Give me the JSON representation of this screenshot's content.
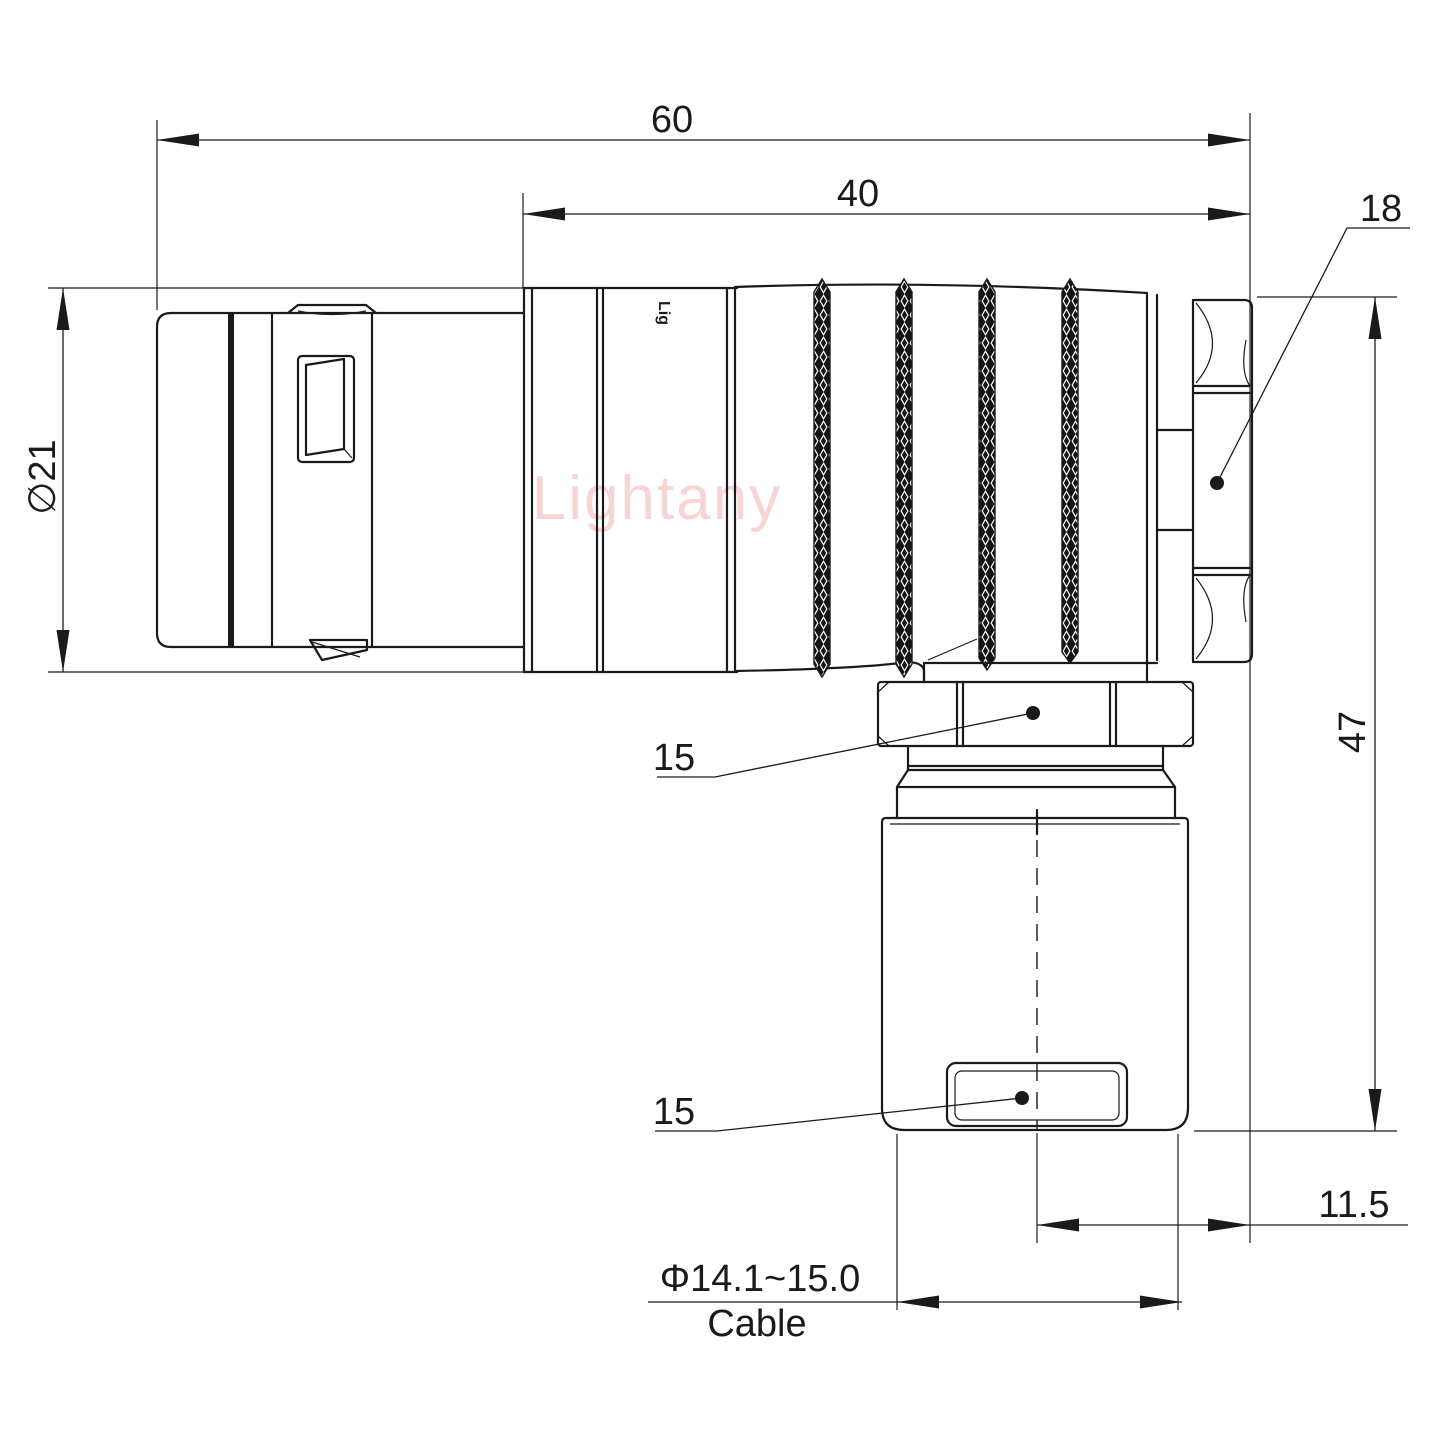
{
  "drawing": {
    "watermark": "Lightany",
    "engraving": "Lig",
    "dimensions": {
      "overall_length": "60",
      "rear_body_length": "40",
      "backnut_size": "18",
      "plug_diameter": "∅21",
      "coupling_nut_size": "15",
      "gland_flat_size": "15",
      "overall_height": "47",
      "axis_offset": "11.5",
      "cable_diameter_range": "Φ14.1~15.0",
      "cable_word": "Cable"
    },
    "colors": {
      "line": "#1a1a1a",
      "watermark": "#f2b4b4",
      "background": "#ffffff"
    }
  }
}
